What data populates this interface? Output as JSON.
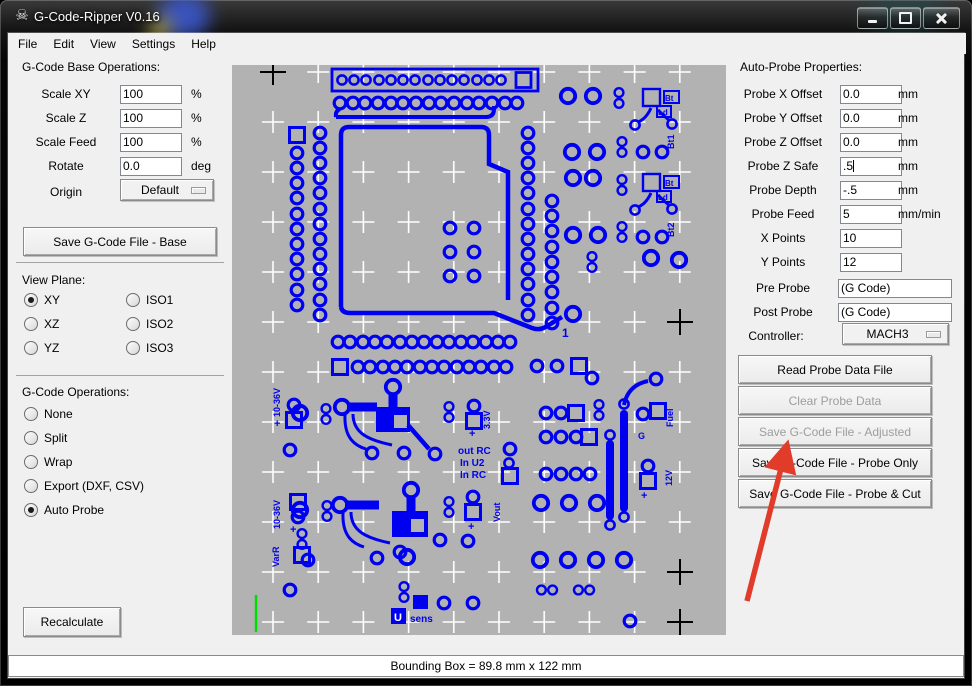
{
  "window": {
    "title": "G-Code-Ripper V0.16"
  },
  "menu": {
    "items": [
      "File",
      "Edit",
      "View",
      "Settings",
      "Help"
    ]
  },
  "left_panel": {
    "base_ops": {
      "title": "G-Code Base Operations:",
      "fields": [
        {
          "label": "Scale XY",
          "value": "100",
          "unit": "%"
        },
        {
          "label": "Scale Z",
          "value": "100",
          "unit": "%"
        },
        {
          "label": "Scale Feed",
          "value": "100",
          "unit": "%"
        },
        {
          "label": "Rotate",
          "value": "0.0",
          "unit": "deg"
        }
      ],
      "origin_label": "Origin",
      "origin_value": "Default",
      "save_button": "Save G-Code File - Base"
    },
    "view_plane": {
      "title": "View Plane:",
      "options": [
        {
          "label": "XY",
          "selected": true
        },
        {
          "label": "ISO1",
          "selected": false
        },
        {
          "label": "XZ",
          "selected": false
        },
        {
          "label": "ISO2",
          "selected": false
        },
        {
          "label": "YZ",
          "selected": false
        },
        {
          "label": "ISO3",
          "selected": false
        }
      ]
    },
    "gcode_ops": {
      "title": "G-Code Operations:",
      "options": [
        {
          "label": "None",
          "selected": false
        },
        {
          "label": "Split",
          "selected": false
        },
        {
          "label": "Wrap",
          "selected": false
        },
        {
          "label": "Export (DXF, CSV)",
          "selected": false
        },
        {
          "label": "Auto Probe",
          "selected": true
        }
      ]
    },
    "recalculate_button": "Recalculate"
  },
  "right_panel": {
    "title": "Auto-Probe Properties:",
    "fields": [
      {
        "label": "Probe X Offset",
        "value": "0.0",
        "unit": "mm"
      },
      {
        "label": "Probe Y Offset",
        "value": "0.0",
        "unit": "mm"
      },
      {
        "label": "Probe Z Offset",
        "value": "0.0",
        "unit": "mm"
      },
      {
        "label": "Probe Z Safe",
        "value": ".5",
        "unit": "mm"
      },
      {
        "label": "Probe Depth",
        "value": "-.5",
        "unit": "mm"
      },
      {
        "label": "Probe Feed",
        "value": "5",
        "unit": "mm/min"
      },
      {
        "label": "X Points",
        "value": "10",
        "unit": ""
      },
      {
        "label": "Y Points",
        "value": "12",
        "unit": ""
      }
    ],
    "gcode_fields": [
      {
        "label": "Pre Probe",
        "value": "(G Code)"
      },
      {
        "label": "Post Probe",
        "value": "(G Code)"
      }
    ],
    "controller_label": "Controller:",
    "controller_value": "MACH3",
    "buttons": [
      {
        "label": "Read Probe Data File",
        "enabled": true
      },
      {
        "label": "Clear Probe Data",
        "enabled": false
      },
      {
        "label": "Save G-Code File - Adjusted",
        "enabled": false
      },
      {
        "label": "Save G-Code File - Probe Only",
        "enabled": true
      },
      {
        "label": "Save G-Code File - Probe & Cut",
        "enabled": true
      }
    ]
  },
  "canvas": {
    "probe_grid": {
      "x_points": 10,
      "y_points": 12
    },
    "colors": {
      "board_bg": "#b2b2b2",
      "trace": "#0000f0",
      "probe_point": "#ffffff",
      "extent_marker": "#000000",
      "origin_marker": "#00dd00",
      "annotation_arrow": "#e13b29"
    },
    "labels": {
      "pin1": "1",
      "bt": "Bt",
      "ld": "Ld",
      "bt1": "Bt1",
      "bt2": "Bt2",
      "v_in_top": "10-36V",
      "v_in_bottom": "10-36V",
      "varr": "VarR",
      "v33": "3.3V",
      "out_rc": "out RC",
      "in_u2": "In U2",
      "in_rc": "In RC",
      "vout": "Vout",
      "u_box": "U",
      "sens": "sens",
      "fuel": "Fuel",
      "g": "G",
      "v12": "12V",
      "plus": "+"
    }
  },
  "annotation": {
    "arrow_target": "Save G-Code File - Adjusted"
  },
  "status_bar": {
    "text": "Bounding Box = 89.8 mm  x 122 mm"
  }
}
